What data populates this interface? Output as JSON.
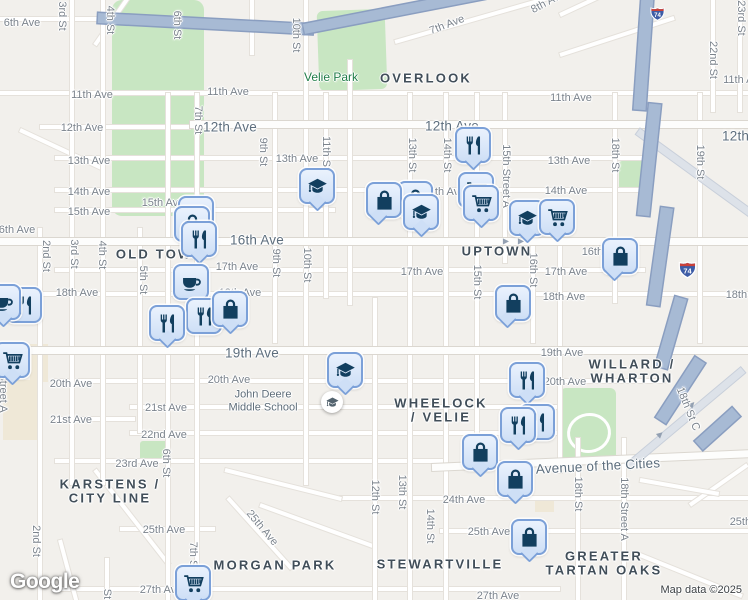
{
  "attribution": {
    "logo_text": "Google",
    "map_data": "Map data ©2025"
  },
  "colors": {
    "land": "#f2f0ec",
    "park": "#c8e6c2",
    "road": "#ffffff",
    "highway": "#a7bad4",
    "marker_fill": "#cedff6",
    "marker_border": "#7ba0d8",
    "marker_glyph": "#123f5f",
    "park_label": "#1f7c47",
    "neighborhood_label": "#414e59",
    "street_label": "#7b838c",
    "main_road_label": "#5d6e7d",
    "shield_red": "#c9413a",
    "shield_blue": "#3d5ca6"
  },
  "icons": {
    "one_way_arrow": "▶"
  },
  "icon_names": {
    "bag": "shopping-bag-icon",
    "cart": "shopping-cart-icon",
    "restaurant": "restaurant-utensils-icon",
    "cafe": "coffee-cup-icon",
    "school": "graduation-cap-icon"
  },
  "highway_shields": [
    {
      "label": "74",
      "x": 649,
      "y": 6,
      "w": 17
    },
    {
      "label": "74",
      "x": 677,
      "y": 260,
      "w": 21
    }
  ],
  "park_labels": [
    {
      "text": "Velie Park",
      "x": 331,
      "y": 77
    }
  ],
  "poi": {
    "school_label_lines": [
      "John Deere",
      "Middle School"
    ],
    "label_x": 263,
    "label_y": 401,
    "icon_x": 321,
    "icon_y": 391
  },
  "neighborhoods": [
    {
      "lines": [
        "OVERLOOK"
      ],
      "x": 426,
      "y": 78
    },
    {
      "lines": [
        "OLD TOWN"
      ],
      "x": 160,
      "y": 254
    },
    {
      "lines": [
        "UPTOWN"
      ],
      "x": 497,
      "y": 251
    },
    {
      "lines": [
        "WHEELOCK",
        "/ VELIE"
      ],
      "x": 441,
      "y": 403
    },
    {
      "lines": [
        "WILLARD /",
        "WHARTON"
      ],
      "x": 632,
      "y": 364
    },
    {
      "lines": [
        "KARSTENS /",
        "CITY LINE"
      ],
      "x": 110,
      "y": 484
    },
    {
      "lines": [
        "MORGAN PARK"
      ],
      "x": 275,
      "y": 565
    },
    {
      "lines": [
        "STEWARTVILLE"
      ],
      "x": 440,
      "y": 564
    },
    {
      "lines": [
        "GREATER",
        "TARTAN OAKS"
      ],
      "x": 604,
      "y": 556
    }
  ],
  "street_labels": [
    {
      "text": "6th Ave",
      "x": 22,
      "y": 23
    },
    {
      "text": "11th Ave",
      "x": 92,
      "y": 95
    },
    {
      "text": "11th Ave",
      "x": 228,
      "y": 92
    },
    {
      "text": "11th Ave",
      "x": 571,
      "y": 98
    },
    {
      "text": "11th Ave",
      "x": 744,
      "y": 80
    },
    {
      "text": "12th Ave",
      "x": 82,
      "y": 128
    },
    {
      "text": "12th Ave",
      "x": 230,
      "y": 127,
      "main": true
    },
    {
      "text": "12th Ave",
      "x": 452,
      "y": 126,
      "main": true
    },
    {
      "text": "12th Ave",
      "x": 749,
      "y": 136,
      "main": true
    },
    {
      "text": "13th Ave",
      "x": 89,
      "y": 161
    },
    {
      "text": "13th Ave",
      "x": 297,
      "y": 159
    },
    {
      "text": "13th Ave",
      "x": 569,
      "y": 161
    },
    {
      "text": "14th Ave",
      "x": 89,
      "y": 192
    },
    {
      "text": "14th Ave",
      "x": 444,
      "y": 192
    },
    {
      "text": "14th Ave",
      "x": 566,
      "y": 191
    },
    {
      "text": "15th Ave",
      "x": 89,
      "y": 212
    },
    {
      "text": "15th Ave",
      "x": 163,
      "y": 203
    },
    {
      "text": "16th Ave",
      "x": 14,
      "y": 230
    },
    {
      "text": "16th Ave",
      "x": 257,
      "y": 240,
      "main": true
    },
    {
      "text": "16th Ave",
      "x": 603,
      "y": 252
    },
    {
      "text": "17th Ave",
      "x": 237,
      "y": 267
    },
    {
      "text": "17th Ave",
      "x": 422,
      "y": 272
    },
    {
      "text": "17th Ave",
      "x": 566,
      "y": 272
    },
    {
      "text": "18th Ave",
      "x": 77,
      "y": 293
    },
    {
      "text": "18th Ave",
      "x": 240,
      "y": 293
    },
    {
      "text": "18th Ave",
      "x": 564,
      "y": 297
    },
    {
      "text": "18th Ave",
      "x": 747,
      "y": 295
    },
    {
      "text": "19th Ave",
      "x": 252,
      "y": 353,
      "main": true
    },
    {
      "text": "19th Ave",
      "x": 562,
      "y": 353
    },
    {
      "text": "20th Ave",
      "x": 71,
      "y": 384
    },
    {
      "text": "20th Ave",
      "x": 229,
      "y": 380
    },
    {
      "text": "20th Ave",
      "x": 565,
      "y": 382
    },
    {
      "text": "21st Ave",
      "x": 71,
      "y": 420
    },
    {
      "text": "21st Ave",
      "x": 166,
      "y": 408
    },
    {
      "text": "22nd Ave",
      "x": 164,
      "y": 435
    },
    {
      "text": "23rd Ave",
      "x": 137,
      "y": 464
    },
    {
      "text": "24th Ave",
      "x": 464,
      "y": 500
    },
    {
      "text": "25th Ave",
      "x": 164,
      "y": 530
    },
    {
      "text": "25th Ave",
      "x": 489,
      "y": 532
    },
    {
      "text": "25th Ave",
      "x": 751,
      "y": 522
    },
    {
      "text": "25th Ave",
      "x": 262,
      "y": 528,
      "rot": 50
    },
    {
      "text": "27th Ave",
      "x": 161,
      "y": 590
    },
    {
      "text": "27th Ave",
      "x": 498,
      "y": 596
    },
    {
      "text": "Avenue of the Cities",
      "x": 598,
      "y": 466,
      "main": true,
      "rot": -3
    },
    {
      "text": "7th Ave",
      "x": 447,
      "y": 25,
      "rot": -21
    },
    {
      "text": "8th Ave",
      "x": 548,
      "y": 2,
      "rot": -28
    }
  ],
  "vertical_street_labels": [
    {
      "text": "3rd St",
      "x": 62,
      "y": 16
    },
    {
      "text": "4th St",
      "x": 110,
      "y": 20
    },
    {
      "text": "6th St",
      "x": 177,
      "y": 25
    },
    {
      "text": "10th St",
      "x": 296,
      "y": 35
    },
    {
      "text": "7th St",
      "x": 198,
      "y": 120
    },
    {
      "text": "9th St",
      "x": 263,
      "y": 152
    },
    {
      "text": "11th St",
      "x": 326,
      "y": 153
    },
    {
      "text": "13th St",
      "x": 412,
      "y": 155
    },
    {
      "text": "14th St",
      "x": 447,
      "y": 155
    },
    {
      "text": "15th Street A",
      "x": 506,
      "y": 176
    },
    {
      "text": "18th St",
      "x": 615,
      "y": 155
    },
    {
      "text": "19th St",
      "x": 700,
      "y": 162
    },
    {
      "text": "22nd St",
      "x": 713,
      "y": 60
    },
    {
      "text": "23rd St",
      "x": 741,
      "y": 18
    },
    {
      "text": "2nd St",
      "x": 46,
      "y": 256
    },
    {
      "text": "3rd St",
      "x": 74,
      "y": 254
    },
    {
      "text": "4th St",
      "x": 102,
      "y": 255
    },
    {
      "text": "5th St",
      "x": 143,
      "y": 280
    },
    {
      "text": "9th St",
      "x": 276,
      "y": 263
    },
    {
      "text": "10th St",
      "x": 307,
      "y": 265
    },
    {
      "text": "15th St",
      "x": 477,
      "y": 282
    },
    {
      "text": "16th St",
      "x": 533,
      "y": 270
    },
    {
      "text": "6th St",
      "x": 166,
      "y": 463
    },
    {
      "text": "2nd St",
      "x": 36,
      "y": 541
    },
    {
      "text": "7th St",
      "x": 193,
      "y": 556
    },
    {
      "text": "12th St",
      "x": 375,
      "y": 497
    },
    {
      "text": "13th St",
      "x": 402,
      "y": 492
    },
    {
      "text": "14th St",
      "x": 430,
      "y": 526
    },
    {
      "text": "18th St",
      "x": 578,
      "y": 494
    },
    {
      "text": "18th Street A",
      "x": 624,
      "y": 509
    },
    {
      "text": "18th St C",
      "x": 688,
      "y": 409,
      "rot": 68
    },
    {
      "text": "Street A",
      "x": 3,
      "y": 393
    },
    {
      "text": "St",
      "x": 107,
      "y": 594
    }
  ],
  "markers": [
    {
      "type": "cart",
      "x": 178,
      "y": 196
    },
    {
      "type": "bag",
      "x": 174,
      "y": 206
    },
    {
      "type": "restaurant",
      "x": 181,
      "y": 221,
      "tip": "c"
    },
    {
      "type": "restaurant",
      "x": 6,
      "y": 287
    },
    {
      "type": "cafe",
      "x": -15,
      "y": 284,
      "tip": "c"
    },
    {
      "type": "cafe",
      "x": 173,
      "y": 264
    },
    {
      "type": "restaurant",
      "x": 186,
      "y": 298
    },
    {
      "type": "restaurant",
      "x": 149,
      "y": 305,
      "tip": "c"
    },
    {
      "type": "bag",
      "x": 212,
      "y": 291,
      "tip": "c"
    },
    {
      "type": "cart",
      "x": -6,
      "y": 342,
      "tip": "c"
    },
    {
      "type": "school",
      "x": 299,
      "y": 168,
      "tip": "c"
    },
    {
      "type": "bag",
      "x": 397,
      "y": 181
    },
    {
      "type": "bag",
      "x": 366,
      "y": 182,
      "tip": "l"
    },
    {
      "type": "school",
      "x": 403,
      "y": 194,
      "tip": "c"
    },
    {
      "type": "cart",
      "x": 458,
      "y": 172
    },
    {
      "type": "cart",
      "x": 463,
      "y": 185,
      "tip": "c"
    },
    {
      "type": "restaurant",
      "x": 455,
      "y": 127,
      "tip": "c"
    },
    {
      "type": "school",
      "x": 509,
      "y": 200,
      "tip": "c"
    },
    {
      "type": "cart",
      "x": 539,
      "y": 199,
      "tip": "c"
    },
    {
      "type": "bag",
      "x": 602,
      "y": 238,
      "tip": "l"
    },
    {
      "type": "bag",
      "x": 495,
      "y": 285,
      "tip": "l"
    },
    {
      "type": "restaurant",
      "x": 509,
      "y": 362,
      "tip": "c"
    },
    {
      "type": "restaurant",
      "x": 519,
      "y": 404
    },
    {
      "type": "restaurant",
      "x": 500,
      "y": 407,
      "tip": "c"
    },
    {
      "type": "school",
      "x": 327,
      "y": 352,
      "tip": "c"
    },
    {
      "type": "bag",
      "x": 462,
      "y": 434,
      "tip": "c"
    },
    {
      "type": "bag",
      "x": 497,
      "y": 461,
      "tip": "c"
    },
    {
      "type": "bag",
      "x": 511,
      "y": 519,
      "tip": "c"
    },
    {
      "type": "cart",
      "x": 175,
      "y": 565,
      "tip": "c"
    }
  ]
}
